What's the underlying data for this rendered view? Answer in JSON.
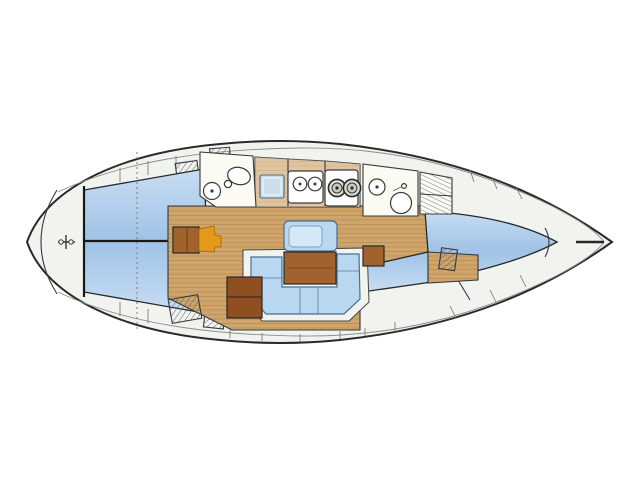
{
  "page": {
    "title": "Sailing yacht interior layout plan (top view, bow to the right)",
    "type": "floor-plan"
  },
  "colors": {
    "outline": "#2a2a2a",
    "deck": "#f1f3ee",
    "band_line": "#8a9089",
    "room": "#fbfbf3",
    "berth_light": "#c8ddf3",
    "berth_mid": "#9fc2e6",
    "settee": "#b9d7f0",
    "settee_inner": "#d4e8f8",
    "settee_stroke": "#49708f",
    "wood": "#d0a56c",
    "wood_line": "#bb9055",
    "table_brown": "#a2622e",
    "cabinet_brown": "#8f4f20",
    "seat_orange": "#e4991c",
    "icebox_blue": "#cbdeec",
    "fixture_stroke": "#3a3a3a"
  },
  "plan": {
    "orientation": {
      "bow": "right",
      "stern": "left",
      "port": "top",
      "starboard": "bottom"
    },
    "compartments": [
      {
        "name": "stern-platform",
        "label": "Stern / swim platform"
      },
      {
        "name": "aft-cabin",
        "label": "Aft cabin - double berths (port and starboard)"
      },
      {
        "name": "aft-head",
        "label": "Aft head - toilet and washbasin"
      },
      {
        "name": "galley",
        "label": "Galley - icebox, twin sinks, two-burner stove"
      },
      {
        "name": "saloon",
        "label": "Saloon - U-settee, table, side settee, navigation desk and chair"
      },
      {
        "name": "forward-head",
        "label": "Forward head - washbasin and toilet"
      },
      {
        "name": "lockers",
        "label": "Lockers / shelving"
      },
      {
        "name": "forward-cabin",
        "label": "Forward cabin - V-berth"
      },
      {
        "name": "bow-locker",
        "label": "Bow / anchor locker"
      }
    ],
    "fixtures": {
      "stove_burners": 2,
      "galley_sinks": 2,
      "toilets": 2,
      "washbasins": 2,
      "berth_cabins": 3,
      "tables": 2
    }
  }
}
